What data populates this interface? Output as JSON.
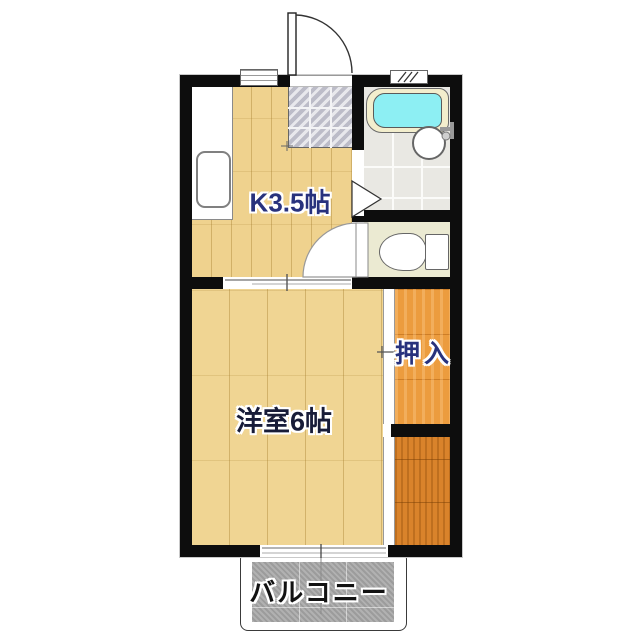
{
  "floorplan": {
    "rooms": {
      "kitchen": {
        "label": "K3.5帖"
      },
      "western_room": {
        "label": "洋室6帖"
      },
      "closet": {
        "label": "押入"
      },
      "balcony": {
        "label": "バルコニー"
      }
    },
    "fixtures": [
      "entrance-door",
      "entry-tile-genkan",
      "kitchen-counter",
      "kitchen-sink",
      "bathtub",
      "washbasin",
      "toilet",
      "toilet-door",
      "bathroom-door",
      "room-sliding-door",
      "closet-sliding-door",
      "storage-closet",
      "balcony-window",
      "top-window",
      "vent"
    ],
    "colors": {
      "wall": "#0d0d0d",
      "wood_floor": "#efd28e",
      "closet_wood": "#ec9c3e",
      "storage_wood": "#d9832b",
      "toilet_floor": "#ebead2",
      "bath_tile": "#e9e8e3",
      "genkan_tile": "#cdccd6",
      "bathtub_water": "#8deff3",
      "bathtub_rim": "#f3eecd",
      "balcony_concrete": "#a8a8a8",
      "label_blue": "#28327d",
      "label_dark": "#181c38"
    }
  }
}
